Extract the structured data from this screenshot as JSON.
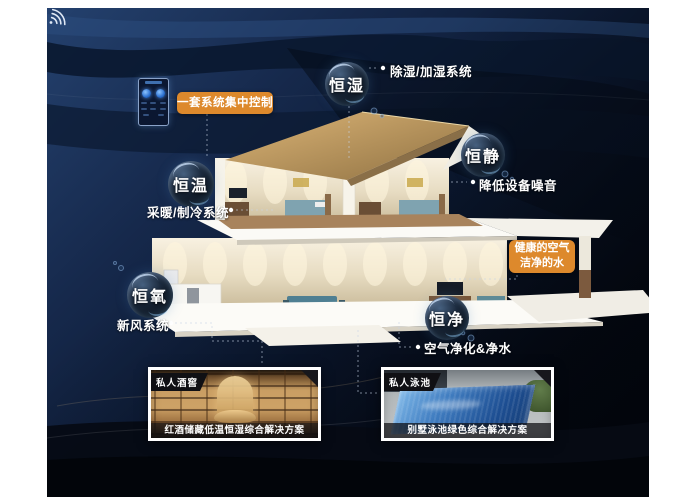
{
  "bubbles": [
    {
      "label": "恒湿",
      "note": "除湿/加湿系统"
    },
    {
      "label": "恒静",
      "note": "降低设备噪音"
    },
    {
      "label": "恒温",
      "note": "采暖/制冷系统"
    },
    {
      "label": "恒氧",
      "note": "新风系统"
    },
    {
      "label": "恒净",
      "note": "空气净化&净水"
    }
  ],
  "callouts": {
    "central_control": "一套系统集中控制",
    "healthy_air": "健康的空气",
    "clean_water": "洁净的水"
  },
  "cards": [
    {
      "badge": "私人酒窖",
      "caption": "红酒储藏低温恒湿综合解决方案"
    },
    {
      "badge": "私人泳池",
      "caption": "别墅泳池绿色综合解决方案"
    }
  ],
  "colors": {
    "accent_orange": "#DD892C",
    "deep_navy": "#0B1830",
    "bubble_highlight": "#CDE1FA"
  },
  "icons": {
    "wifi": "wifi-icon",
    "smartphone": "smartphone-icon"
  }
}
